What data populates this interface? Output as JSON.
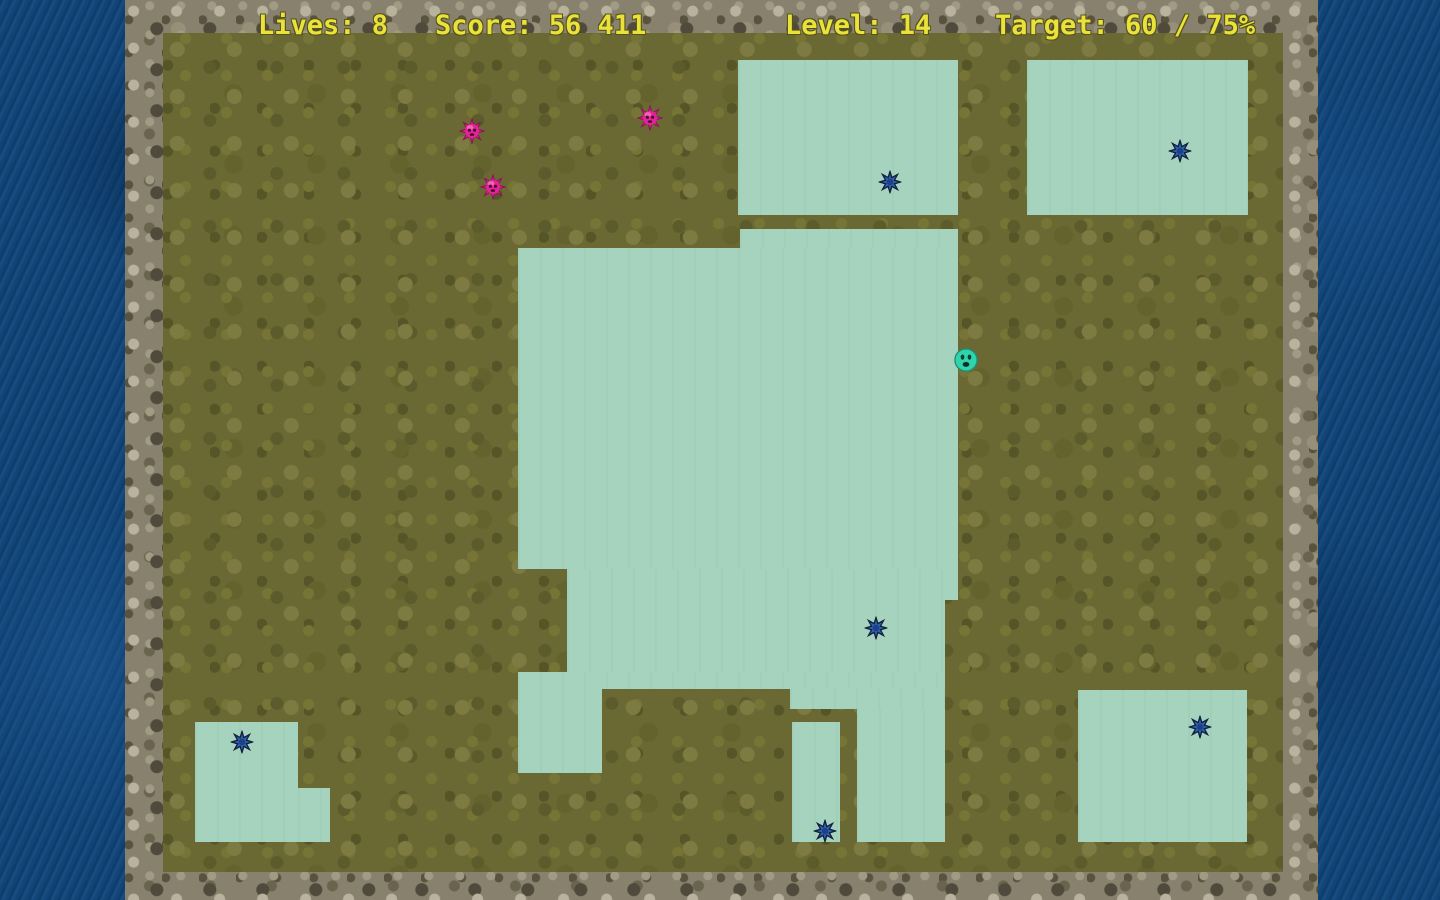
{
  "hud": {
    "lives_label": "Lives: 8",
    "score_label": "Score: 56 411",
    "level_label": "Level: 14",
    "target_label": "Target: 60 / 75%",
    "lives": 8,
    "score": "56 411",
    "level": 14,
    "target_progress_percent": 60,
    "target_goal_percent": 75
  },
  "game": {
    "colors": {
      "claimed_fill": "#a6d3bd",
      "field_olive": "#6b6933",
      "stone_frame": "#87816d",
      "border_blue": "#11457a",
      "hud_text": "#eae23a",
      "enemy_pink": "#df1f8e",
      "enemy_blue": "#2f63ad",
      "player_teal": "#2fd4ad"
    },
    "claimed_regions": [
      {
        "x": 738,
        "y": 60,
        "w": 220,
        "h": 155
      },
      {
        "x": 1027,
        "y": 60,
        "w": 221,
        "h": 155
      },
      {
        "x": 740,
        "y": 229,
        "w": 218,
        "h": 19
      },
      {
        "x": 518,
        "y": 248,
        "w": 440,
        "h": 321
      },
      {
        "x": 567,
        "y": 569,
        "w": 391,
        "h": 31
      },
      {
        "x": 567,
        "y": 600,
        "w": 378,
        "h": 72
      },
      {
        "x": 518,
        "y": 672,
        "w": 427,
        "h": 17
      },
      {
        "x": 518,
        "y": 689,
        "w": 84,
        "h": 84
      },
      {
        "x": 790,
        "y": 689,
        "w": 155,
        "h": 20
      },
      {
        "x": 857,
        "y": 709,
        "w": 88,
        "h": 133
      },
      {
        "x": 792,
        "y": 722,
        "w": 48,
        "h": 120
      },
      {
        "x": 195,
        "y": 722,
        "w": 103,
        "h": 120
      },
      {
        "x": 298,
        "y": 788,
        "w": 32,
        "h": 54
      },
      {
        "x": 1078,
        "y": 690,
        "w": 169,
        "h": 152
      }
    ],
    "entities": {
      "player": {
        "x": 966,
        "y": 360
      },
      "pink_enemies": [
        {
          "x": 472,
          "y": 131
        },
        {
          "x": 493,
          "y": 187
        },
        {
          "x": 650,
          "y": 118
        }
      ],
      "blue_enemies": [
        {
          "x": 890,
          "y": 182
        },
        {
          "x": 1180,
          "y": 151
        },
        {
          "x": 876,
          "y": 628
        },
        {
          "x": 242,
          "y": 742
        },
        {
          "x": 1200,
          "y": 727
        },
        {
          "x": 825,
          "y": 831
        }
      ]
    }
  }
}
